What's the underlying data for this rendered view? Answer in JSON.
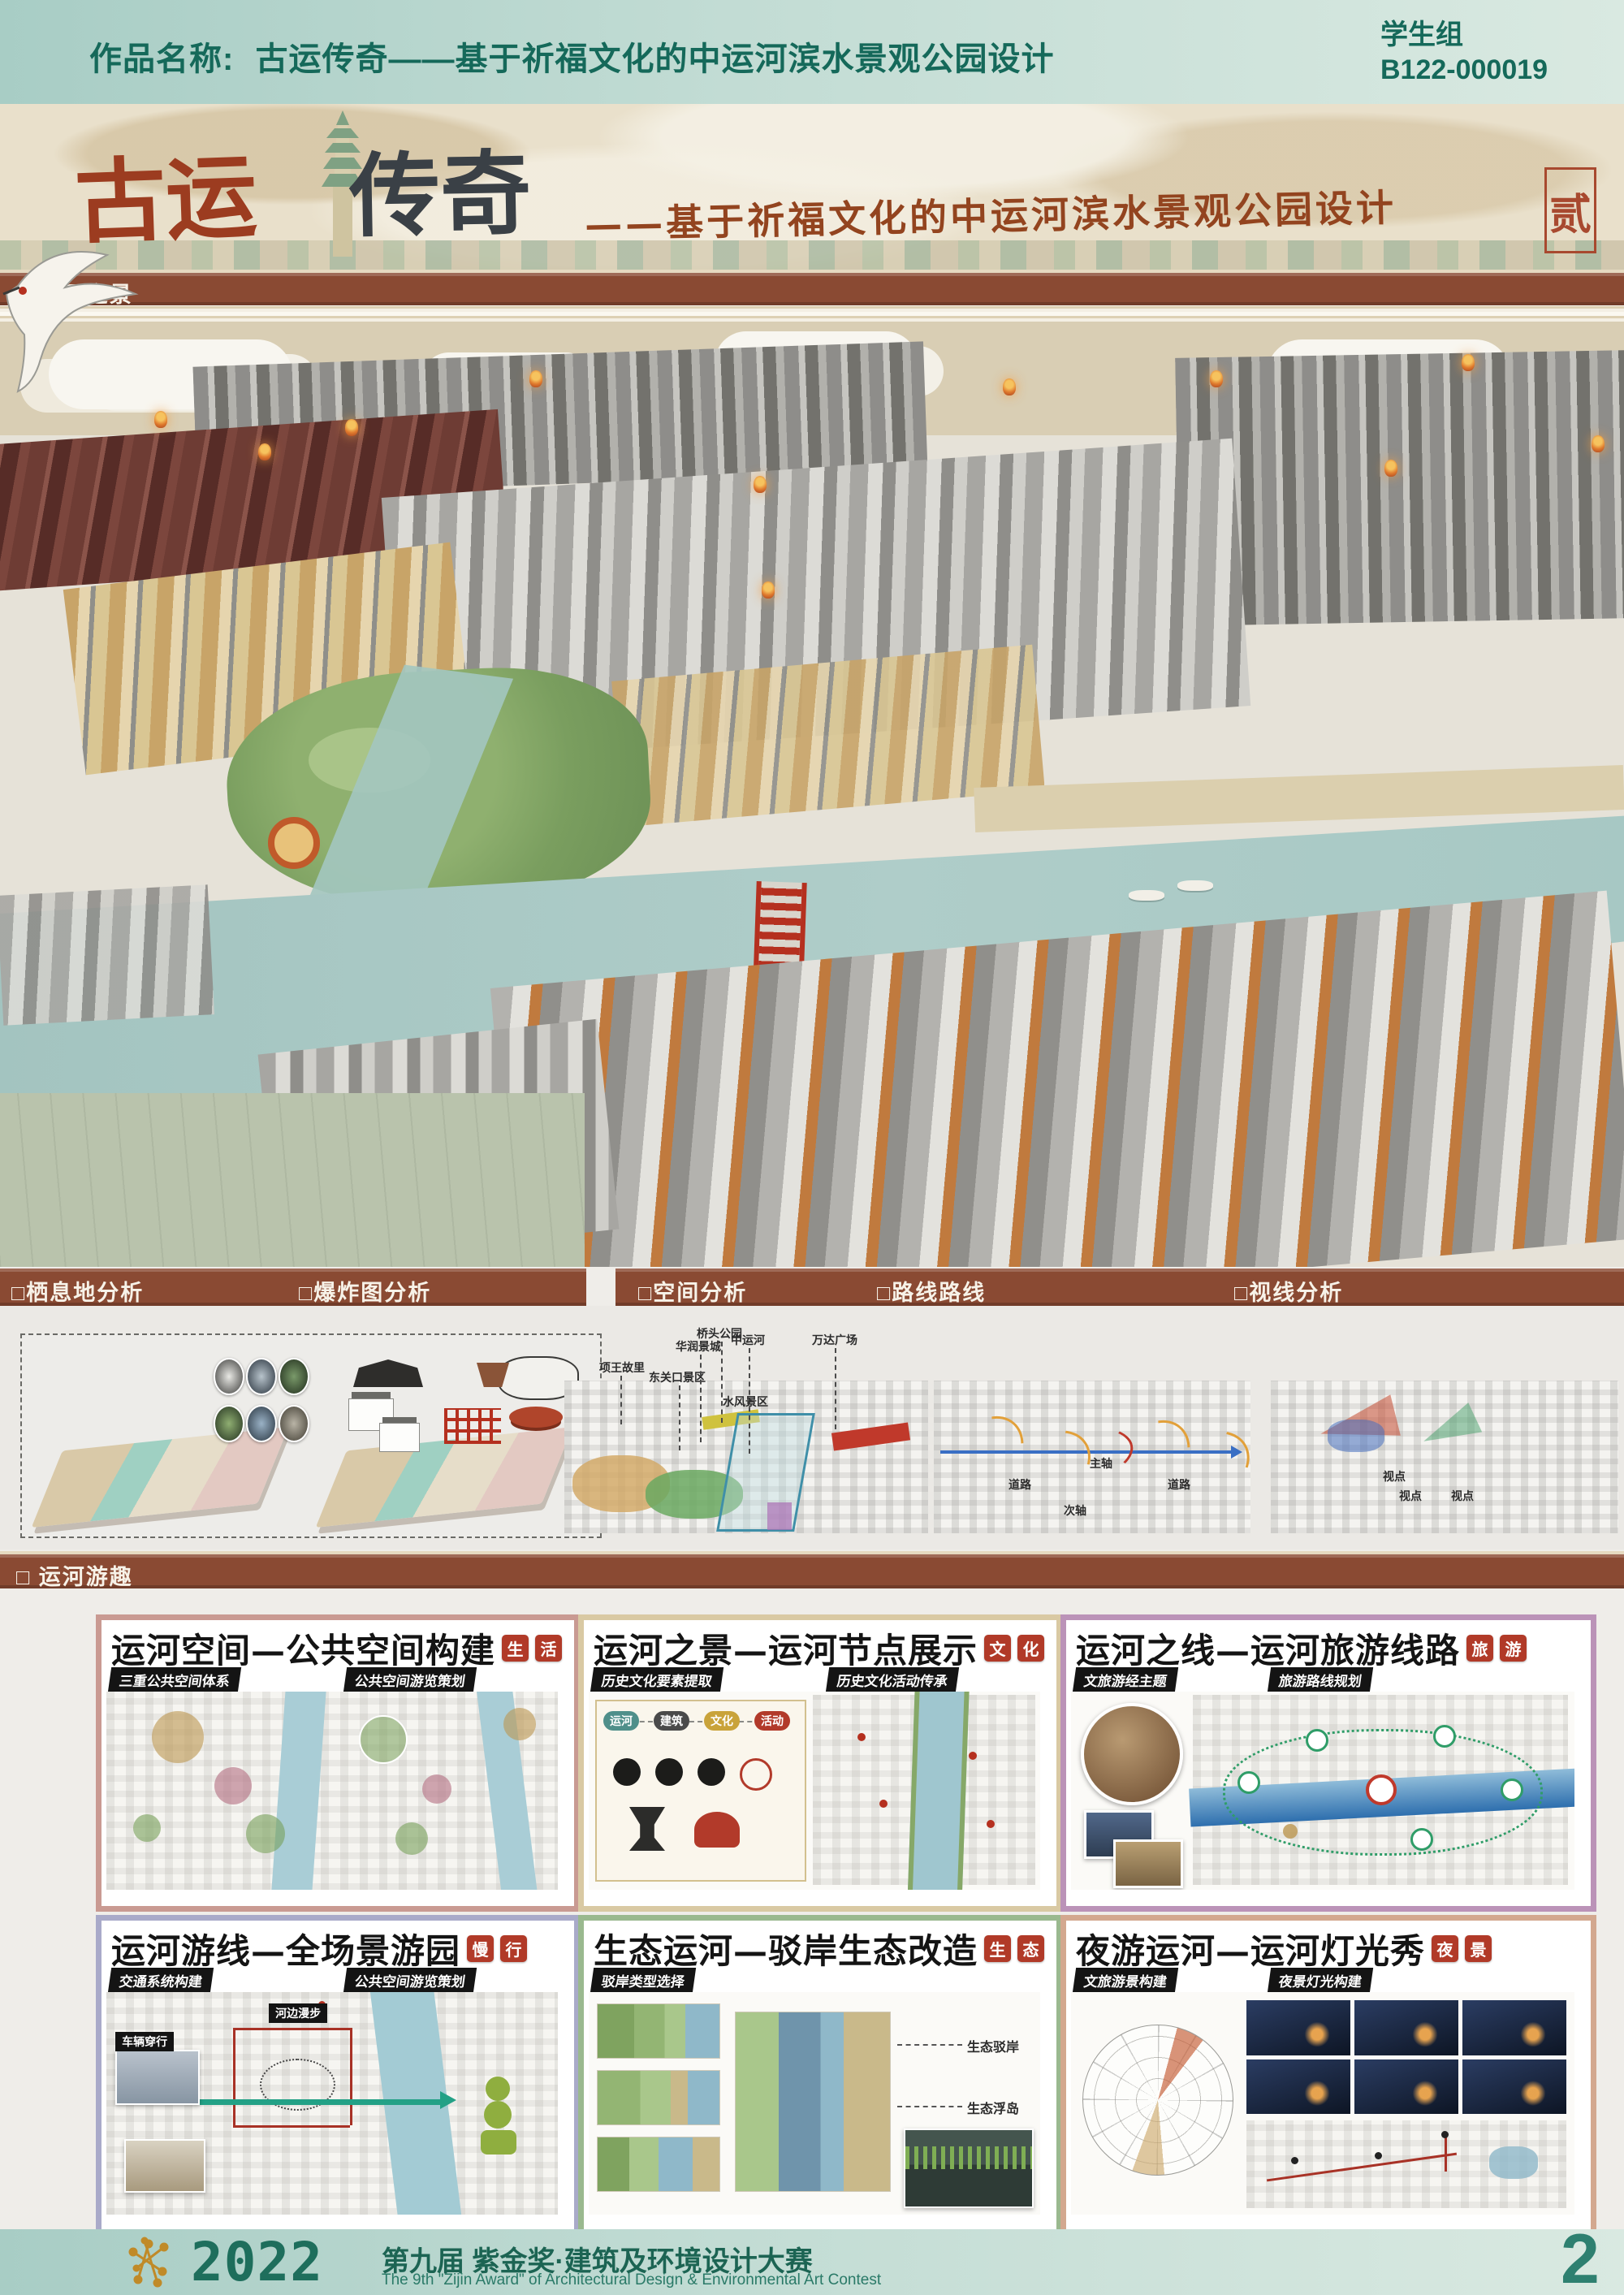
{
  "header": {
    "label": "作品名称:",
    "title": "古运传奇——基于祈福文化的中运河滨水景观公园设计",
    "group": "学生组",
    "entry_id": "B122-000019"
  },
  "banner": {
    "title_part1": "古运",
    "title_part2": "传奇",
    "subtitle": "——基于祈福文化的中运河滨水景观公园设计",
    "seal": "贰"
  },
  "section_scene": "□ 运河之景",
  "section_fun": "□ 运河游趣",
  "analysis": {
    "left_bar": [
      "□栖息地分析",
      "□爆炸图分析"
    ],
    "right_bar": [
      "□空间分析",
      "□路线路线",
      "□视线分析"
    ],
    "space_labels": [
      "项王故里",
      "东关口景区",
      "华润景城",
      "桥头公园",
      "中运河",
      "万达广场",
      "水风景区"
    ],
    "route_labels": [
      "道路",
      "主轴",
      "次轴",
      "道路"
    ],
    "sight_labels": [
      "视点",
      "视点",
      "视点"
    ]
  },
  "panels": [
    {
      "title": "运河空间—公共空间构建",
      "seal1": "生",
      "seal2": "活",
      "tag1": "三重公共空间体系",
      "tag2": "公共空间游览策划"
    },
    {
      "title": "运河之景—运河节点展示",
      "seal1": "文",
      "seal2": "化",
      "tag1": "历史文化要素提取",
      "tag2": "历史文化活动传承",
      "legend": [
        "运河",
        "建筑",
        "文化",
        "活动"
      ]
    },
    {
      "title": "运河之线—运河旅游线路",
      "seal1": "旅",
      "seal2": "游",
      "tag1": "文旅游经主题",
      "tag2": "旅游路线规划"
    },
    {
      "title": "运河游线—全场景游园",
      "seal1": "慢",
      "seal2": "行",
      "tag1": "交通系统构建",
      "tag2": "公共空间游览策划",
      "note1": "车辆穿行",
      "note2": "河边漫步"
    },
    {
      "title": "生态运河—驳岸生态改造",
      "seal1": "生",
      "seal2": "态",
      "tag1": "驳岸类型选择",
      "note1": "生态驳岸",
      "note2": "生态浮岛"
    },
    {
      "title": "夜游运河—运河灯光秀",
      "seal1": "夜",
      "seal2": "景",
      "tag1": "文旅游景构建",
      "tag2": "夜景灯光构建"
    }
  ],
  "footer": {
    "year": "2022",
    "title": "第九届 紫金奖·建筑及环境设计大赛",
    "subtitle": "The 9th \"Zijin Award\" of Architectural Design & Environmental Art Contest",
    "page": "2"
  }
}
